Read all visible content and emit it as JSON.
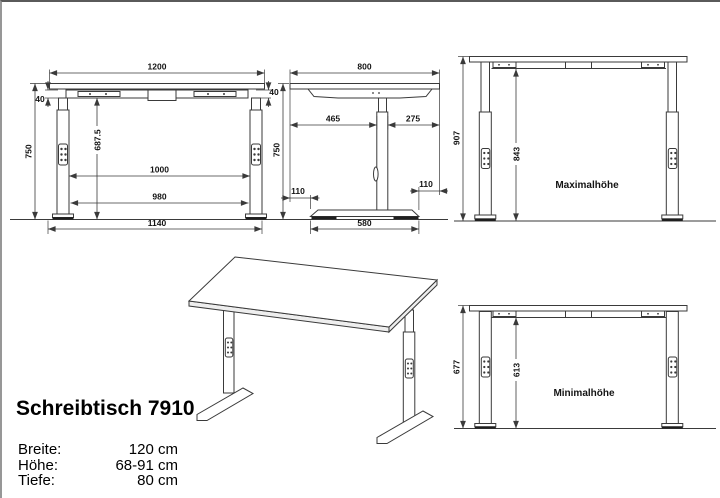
{
  "product": {
    "title": "Schreibtisch 7910",
    "specs": [
      {
        "label": "Breite:",
        "value": "120 cm"
      },
      {
        "label": "Höhe:",
        "value": "68-91 cm"
      },
      {
        "label": "Tiefe:",
        "value": "80 cm"
      }
    ]
  },
  "views": {
    "front": {
      "w_top": "1200",
      "apron_l": "40",
      "apron_r": "40",
      "h": "750",
      "clear_h": "687.5",
      "inner_top": "1000",
      "inner_bottom": "980",
      "feet_span": "1140"
    },
    "side": {
      "depth": "800",
      "front_seg": "465",
      "rear_seg": "275",
      "h": "750",
      "overhang_f": "110",
      "overhang_r": "110",
      "base_depth": "580"
    },
    "max": {
      "label": "Maximalhöhe",
      "total": "907",
      "clear": "843"
    },
    "min": {
      "label": "Minimalhöhe",
      "total": "677",
      "clear": "613"
    }
  },
  "colors": {
    "line": "#3a3a3a",
    "pad": "#1f1f1f",
    "background": "#ffffff"
  }
}
